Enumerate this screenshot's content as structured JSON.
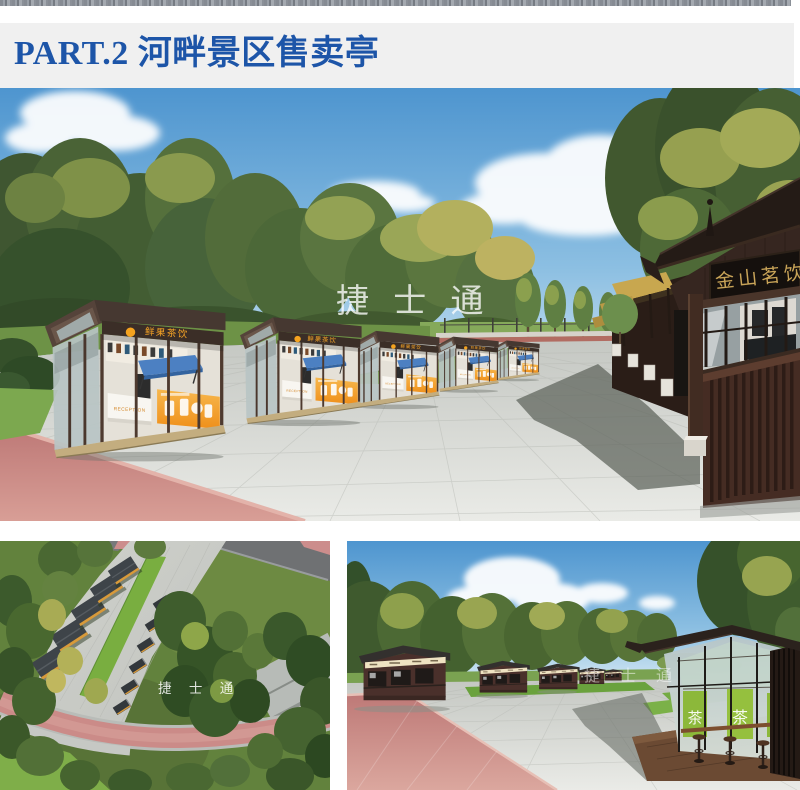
{
  "header": {
    "title": "PART.2 河畔景区售卖亭"
  },
  "watermark": {
    "text": "捷 士 通"
  },
  "main_render": {
    "kiosk_sign": "鲜果茶饮",
    "reception_label": "RECEPTION",
    "plaque_text": "金山茗饮"
  },
  "street_render": {
    "banner_char": "茶"
  },
  "colors": {
    "title_blue": "#1d55a8",
    "header_band": "#f0f0f0",
    "accent_orange": "#f5a31f",
    "plaque_gold": "#c9a458",
    "lawn_green": "#7ab043",
    "path_pink": "#c98989"
  }
}
